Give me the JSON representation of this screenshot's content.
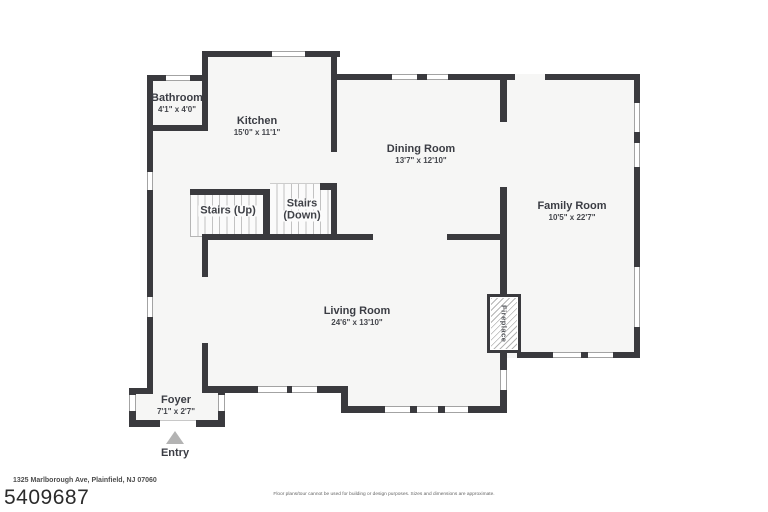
{
  "colors": {
    "wall": "#3a3a3e",
    "room_fill": "#f6f6f5",
    "label_text": "#3b3d44",
    "window_line": "#a3a3a3",
    "tread_line": "#c2c2c2",
    "entry_arrow": "#b3b3b3"
  },
  "rooms": [
    {
      "name": "Bathroom",
      "dims": "4'1\" x 4'0\""
    },
    {
      "name": "Kitchen",
      "dims": "15'0\" x 11'1\""
    },
    {
      "name": "Dining Room",
      "dims": "13'7\" x 12'10\""
    },
    {
      "name": "Family Room",
      "dims": "10'5\" x 22'7\""
    },
    {
      "name": "Living Room",
      "dims": "24'6\" x 13'10\""
    },
    {
      "name": "Foyer",
      "dims": "7'1\" x 2'7\""
    }
  ],
  "stairs": {
    "up_label": "Stairs (Up)",
    "down_label_line1": "Stairs",
    "down_label_line2": "(Down)"
  },
  "labels": {
    "fireplace": "Fireplace",
    "entry": "Entry"
  },
  "footer": {
    "address": "1325 Marlborough Ave, Plainfield, NJ 07060",
    "mls_number": "5409687",
    "disclaimer": "Floor plans/tour cannot be used for building or design purposes. Sizes and dimensions are approximate."
  }
}
